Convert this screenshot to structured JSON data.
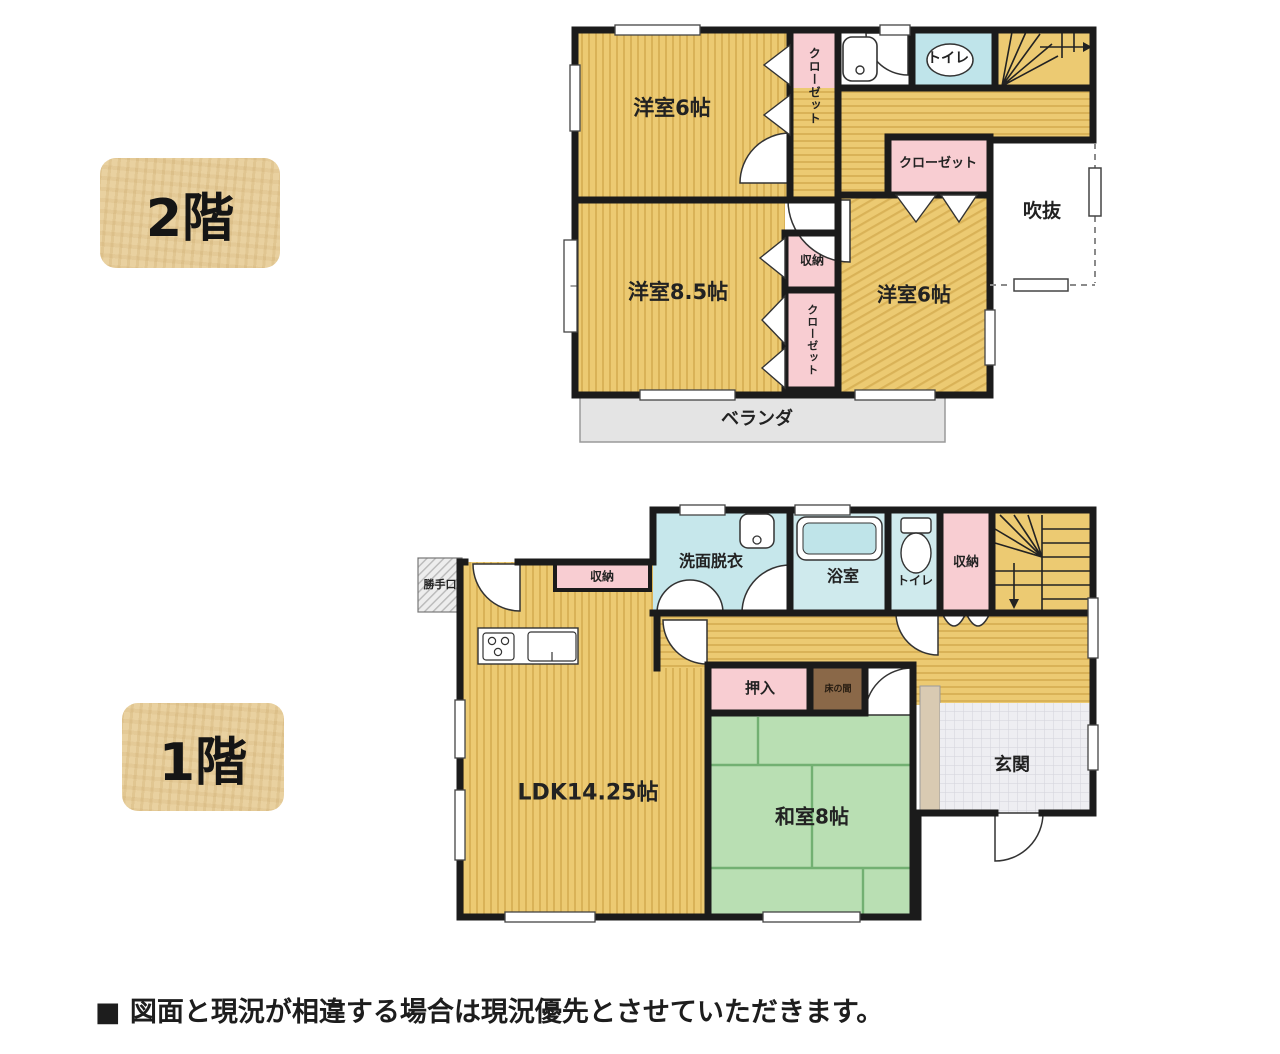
{
  "floor2": {
    "badge": "2階",
    "rooms": {
      "bedroom_top": "洋室6帖",
      "closet_top": "クローゼット",
      "toilet": "トイレ",
      "closet_mid": "クローゼット",
      "atrium": "吹抜",
      "bedroom_left": "洋室8.5帖",
      "storage": "収納",
      "closet_center": "クローゼット",
      "bedroom_right": "洋室6帖",
      "veranda": "ベランダ"
    }
  },
  "floor1": {
    "badge": "1階",
    "rooms": {
      "back_door": "勝手口",
      "storage_kitchen": "収納",
      "washroom": "洗面脱衣",
      "bathroom": "浴室",
      "toilet": "トイレ",
      "storage_hall": "収納",
      "ldk": "LDK14.25帖",
      "oshiire": "押入",
      "tokonoma": "床の間",
      "washitsu": "和室8帖",
      "entrance": "玄関"
    }
  },
  "disclaimer": "■ 図面と現況が相違する場合は現況優先とさせていただきます。",
  "colors": {
    "wall": "#1b1b1b",
    "room_yellow": "#ecca72",
    "room_yellow_stripe": "#d9b257",
    "closet_pink": "#f8cdd2",
    "wet_blue": "#c6e7eb",
    "toilet_blue": "#bfe4ea",
    "bath_blue": "#cfeaed",
    "tatami_green": "#b9dfb3",
    "tatami_line": "#72b072",
    "veranda_gray": "#e4e4e4",
    "entrance_tile": "#eeeef2",
    "step_beige": "#d9cab2",
    "tokonoma_brown": "#8a6848",
    "badge_bg": "#e9d1a0"
  }
}
